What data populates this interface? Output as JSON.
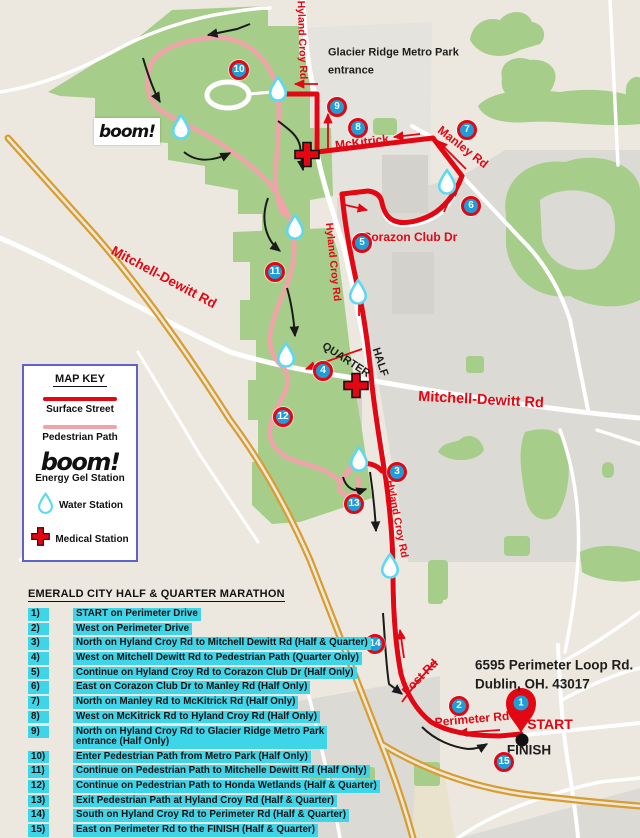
{
  "map": {
    "boom_logo": "boom!",
    "colors": {
      "route_red": "#e30613",
      "pedestrian_pink": "#f0a3a8",
      "waypoint_blue": "#1d9ed9",
      "water_cyan": "#5cd9f2",
      "highlight_cyan": "#3fd5e9",
      "highway_yellow": "#d89d30",
      "park_green": "#a7cd8b",
      "key_border_blue": "#5f62c9"
    },
    "waypoints": [
      {
        "n": "1",
        "x": 521,
        "y": 703,
        "small": true
      },
      {
        "n": "2",
        "x": 459,
        "y": 706
      },
      {
        "n": "3",
        "x": 397,
        "y": 472
      },
      {
        "n": "4",
        "x": 323,
        "y": 371
      },
      {
        "n": "5",
        "x": 362,
        "y": 243
      },
      {
        "n": "6",
        "x": 471,
        "y": 206
      },
      {
        "n": "7",
        "x": 467,
        "y": 130
      },
      {
        "n": "8",
        "x": 358,
        "y": 128
      },
      {
        "n": "9",
        "x": 337,
        "y": 107
      },
      {
        "n": "10",
        "x": 239,
        "y": 70
      },
      {
        "n": "11",
        "x": 275,
        "y": 272
      },
      {
        "n": "12",
        "x": 283,
        "y": 417
      },
      {
        "n": "13",
        "x": 354,
        "y": 504
      },
      {
        "n": "14",
        "x": 375,
        "y": 644
      },
      {
        "n": "15",
        "x": 504,
        "y": 762
      }
    ],
    "water_stations": [
      {
        "x": 278,
        "y": 91
      },
      {
        "x": 181,
        "y": 129
      },
      {
        "x": 295,
        "y": 229
      },
      {
        "x": 447,
        "y": 184
      },
      {
        "x": 358,
        "y": 294
      },
      {
        "x": 286,
        "y": 357
      },
      {
        "x": 359,
        "y": 461
      },
      {
        "x": 390,
        "y": 568
      }
    ],
    "medical_stations": [
      {
        "x": 307,
        "y": 157
      },
      {
        "x": 356,
        "y": 388
      }
    ],
    "labels": [
      {
        "text": "Hyland Croy Rd",
        "x": 302,
        "y": 40,
        "rot": 88,
        "size": 10.5,
        "c": "red"
      },
      {
        "text": "Glacier Ridge Metro Park entrance",
        "x": 328,
        "y": 62,
        "rot": 0,
        "size": 11,
        "c": "black",
        "w": 135,
        "anchor": "left",
        "lh": 1.6
      },
      {
        "text": "McKitrick",
        "x": 362,
        "y": 142,
        "rot": -7,
        "size": 12,
        "c": "red"
      },
      {
        "text": "Manley Rd",
        "x": 463,
        "y": 147,
        "rot": 38,
        "size": 12,
        "c": "red"
      },
      {
        "text": "Corazon Club Dr",
        "x": 410,
        "y": 237,
        "rot": 0,
        "size": 12,
        "c": "red"
      },
      {
        "text": "Hyland Croy Rd",
        "x": 333,
        "y": 262,
        "rot": 84,
        "size": 10.5,
        "c": "red"
      },
      {
        "text": "Mitchell-Dewitt Rd",
        "x": 164,
        "y": 277,
        "rot": 28,
        "size": 13.5,
        "c": "red"
      },
      {
        "text": "QUARTER",
        "x": 346,
        "y": 360,
        "rot": 33,
        "size": 11,
        "c": "black"
      },
      {
        "text": "HALF",
        "x": 380,
        "y": 362,
        "rot": 72,
        "size": 11,
        "c": "black"
      },
      {
        "text": "Mitchell-Dewitt Rd",
        "x": 481,
        "y": 400,
        "rot": 3,
        "size": 14.5,
        "c": "red"
      },
      {
        "text": "Hyland Croy Rd",
        "x": 397,
        "y": 519,
        "rot": 79,
        "size": 10.5,
        "c": "red"
      },
      {
        "text": "Post Rd",
        "x": 420,
        "y": 677,
        "rot": -45,
        "size": 12,
        "c": "red"
      },
      {
        "text": "Perimeter Rd",
        "x": 472,
        "y": 719,
        "rot": -5,
        "size": 12,
        "c": "red"
      },
      {
        "text": "6595 Perimeter Loop Rd.",
        "x": 475,
        "y": 665,
        "rot": 0,
        "size": 13.5,
        "c": "black",
        "anchor": "left"
      },
      {
        "text": "Dublin, OH. 43017",
        "x": 475,
        "y": 684,
        "rot": 0,
        "size": 13.5,
        "c": "black",
        "anchor": "left"
      },
      {
        "text": "START",
        "x": 550,
        "y": 724,
        "rot": 0,
        "size": 14,
        "c": "red"
      },
      {
        "text": "FINISH",
        "x": 529,
        "y": 750,
        "rot": 0,
        "size": 13.5,
        "c": "black"
      }
    ]
  },
  "key": {
    "title": "MAP KEY",
    "surface_street": "Surface Street",
    "pedestrian_path": "Pedestrian Path",
    "boom": "boom!",
    "energy": "Energy Gel Station",
    "water": "Water Station",
    "medical": "Medical Station"
  },
  "directions": {
    "title": "EMERALD CITY HALF & QUARTER MARATHON",
    "items": [
      {
        "num": "1)",
        "text": "START on Perimeter Drive"
      },
      {
        "num": "2)",
        "text": "West on Perimeter Drive"
      },
      {
        "num": "3)",
        "text": "North on Hyland Croy Rd to Mitchell Dewitt Rd (Half & Quarter)"
      },
      {
        "num": "4)",
        "text": "West on Mitchell Dewitt Rd to Pedestrian Path (Quarter Only)"
      },
      {
        "num": "5)",
        "text": "Continue on Hyland Croy Rd to Corazon Club Dr (Half Only)"
      },
      {
        "num": "6)",
        "text": "East on Corazon Club Dr to Manley Rd (Half Only)"
      },
      {
        "num": "7)",
        "text": "North on Manley Rd to McKitrick Rd (Half Only)"
      },
      {
        "num": "8)",
        "text": "West on McKitrick Rd to Hyland Croy Rd (Half Only)"
      },
      {
        "num": "9)",
        "text": "North on Hyland Croy Rd to Glacier Ridge Metro Park\nentrance (Half Only)"
      },
      {
        "num": "10)",
        "text": "Enter Pedestrian Path from Metro Park (Half Only)"
      },
      {
        "num": "11)",
        "text": "Continue on Pedestrian Path to Mitchelle Dewitt Rd (Half Only)"
      },
      {
        "num": "12)",
        "text": "Continue on Pedestrian Path to Honda Wetlands (Half & Quarter)"
      },
      {
        "num": "13)",
        "text": "Exit Pedestrian Path at Hyland Croy Rd (Half & Quarter)"
      },
      {
        "num": "14)",
        "text": "South on Hyland Croy Rd to Perimeter Rd (Half & Quarter)"
      },
      {
        "num": "15)",
        "text": "East on Perimeter Rd to the FINISH (Half & Quarter)"
      }
    ]
  }
}
